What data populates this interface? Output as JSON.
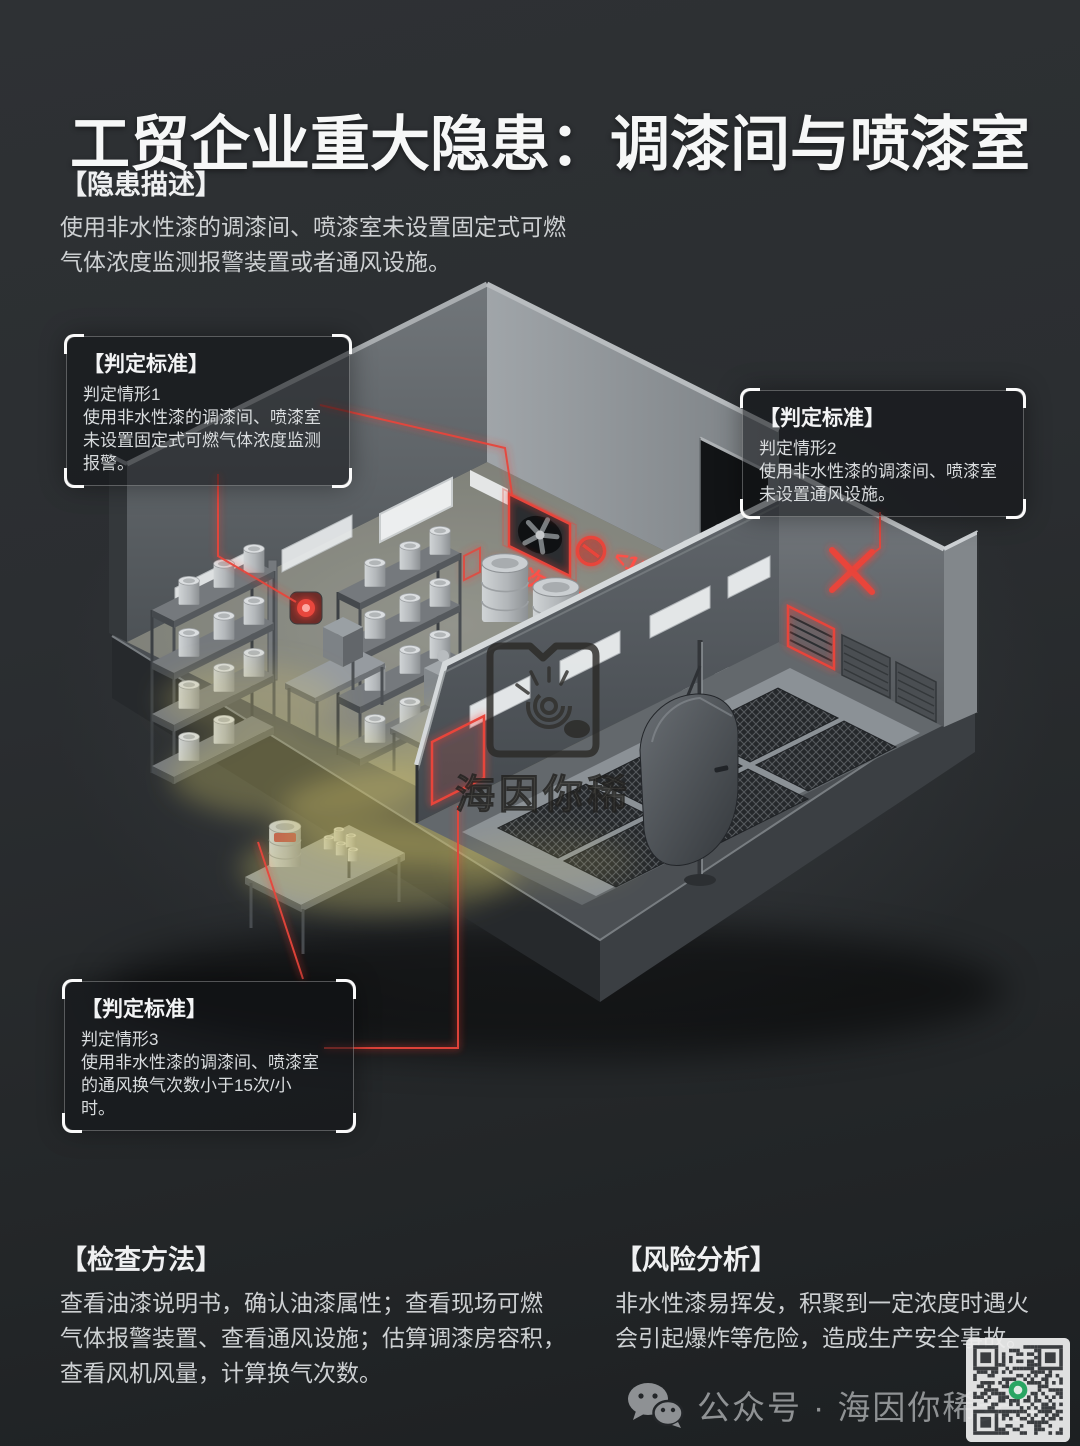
{
  "title": "工贸企业重大隐患：调漆间与喷漆室",
  "hazard": {
    "heading": "【隐患描述】",
    "lines": [
      "使用非水性漆的调漆间、喷漆室未设置固定式可燃",
      "气体浓度监测报警装置或者通风设施。"
    ]
  },
  "callouts": [
    {
      "heading": "【判定标准】",
      "lines": [
        "判定情形1",
        "使用非水性漆的调漆间、喷漆室",
        "未设置固定式可燃气体浓度监测",
        "报警。"
      ]
    },
    {
      "heading": "【判定标准】",
      "lines": [
        "判定情形2",
        "使用非水性漆的调漆间、喷漆室",
        "未设置通风设施。"
      ]
    },
    {
      "heading": "【判定标准】",
      "lines": [
        "判定情形3",
        "使用非水性漆的调漆间、喷漆室",
        "的通风换气次数小于15次/小",
        "时。"
      ]
    }
  ],
  "scene": {
    "air_change_label_1": "<15次/小时",
    "air_change_label_2": "<15次/小时",
    "watermark_text": "海因你稀"
  },
  "inspection": {
    "heading": "【检查方法】",
    "lines": [
      "查看油漆说明书，确认油漆属性；查看现场可燃",
      "气体报警装置、查看通风设施；估算调漆房容积，",
      "查看风机风量，计算换气次数。"
    ]
  },
  "risk": {
    "heading": "【风险分析】",
    "lines": [
      "非水性漆易挥发，积聚到一定浓度时遇火",
      "会引起爆炸等危险，造成生产安全事故。"
    ]
  },
  "footer": {
    "account_label": "公众号 · 海因你稀安全"
  },
  "colors": {
    "accent_red": "#e8453b",
    "vapor_yellow": "#cdc06a",
    "qr_green": "#2aae67",
    "background_dark": "#24272a"
  }
}
